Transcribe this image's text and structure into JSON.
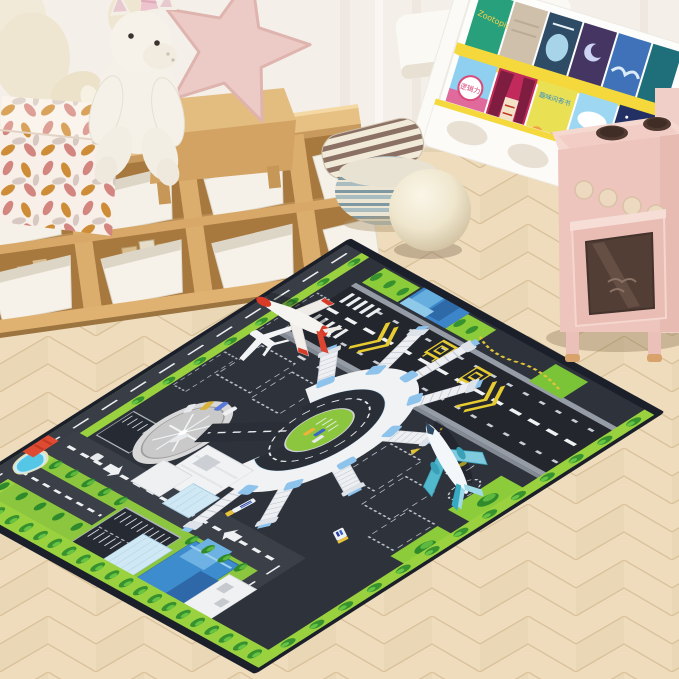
{
  "scene": {
    "alt": "Kids playroom with airport-themed play rug, wooden toy storage shelf, plush unicorn and star cushion, book rack and pink play kitchen on herringbone wood floor"
  },
  "books": {
    "titles": [
      "Zootopia",
      "逻辑力",
      "趣味问答书",
      "冰雪奇缘"
    ]
  },
  "rug": {
    "theme_elements": [
      "runway",
      "taxiway",
      "circular-terminal",
      "jet-bridges",
      "helipad-roundabout",
      "helicopter",
      "parking-lot",
      "pond",
      "city-roads",
      "u-turn-loop",
      "airplanes",
      "fuel-trucks",
      "tree-rows",
      "hold-position-markings",
      "yellow-chevrons"
    ],
    "colors": {
      "border": "#1b1f2a",
      "tarmac": "#2e323b",
      "runway": "#23262d",
      "road": "#3a3f48",
      "grass": "#8cc63e",
      "grass_strip": "#9ad23f",
      "tree": "#2f8a2c",
      "marking_white": "#eef0f2",
      "marking_yellow": "#e6cb31",
      "terminal_white": "#f1f2f4",
      "glass_blue": "#8ec3ec"
    }
  },
  "palette": {
    "wall": "#f4efe9",
    "floor_wood": "#eedcbc",
    "shelf_wood": "#e2bb7d",
    "bin_white": "#f5f1e8",
    "cube_pink_leaf": "#d4847c",
    "cube_orange_leaf": "#cf8a2e",
    "star_pink": "#eccbc6",
    "pouf_blue": "#a9bcc0",
    "cushion_brown": "#8a7164",
    "ball_cream": "#f3ecd9",
    "kitchen_pink": "#eec5bd",
    "burner_brown": "#503a31",
    "plane_red": "#d83a28",
    "plane_teal": "#52b8cc"
  }
}
